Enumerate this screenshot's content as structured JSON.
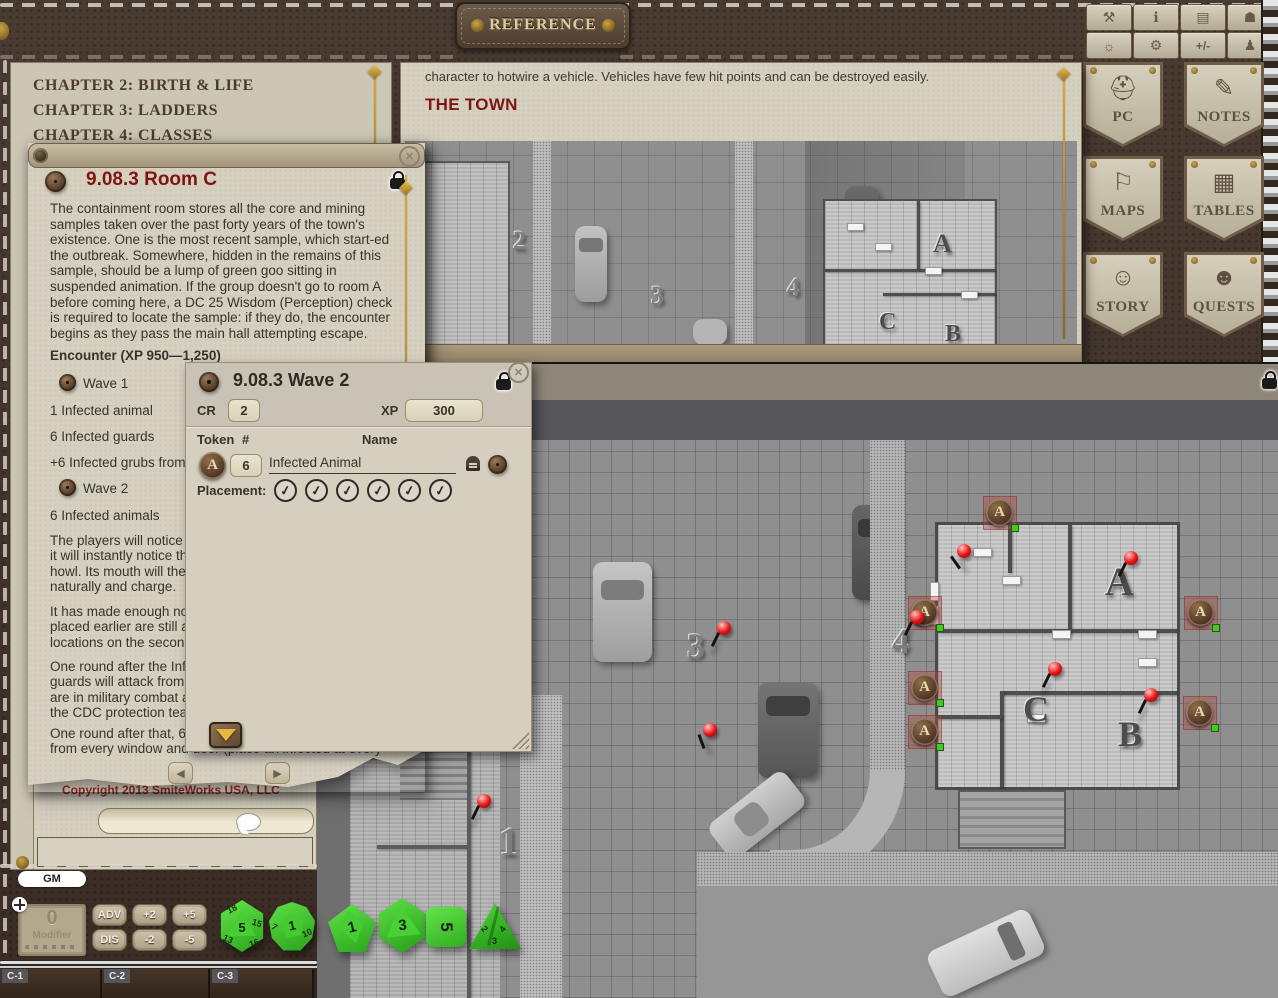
{
  "app": {
    "title_plaque": "REFERENCE",
    "close_glyph": "✕",
    "check_glyph": "✓",
    "left_arrow": "◀",
    "right_arrow": "▶"
  },
  "toolbar": {
    "icons": [
      {
        "name": "tools",
        "glyph": "⚒"
      },
      {
        "name": "party-info",
        "glyph": "ℹ"
      },
      {
        "name": "library",
        "glyph": "▤"
      },
      {
        "name": "dice-pouch",
        "glyph": "☗"
      },
      {
        "name": "day-night",
        "glyph": "☼"
      },
      {
        "name": "options",
        "glyph": "⚙"
      },
      {
        "name": "modifiers",
        "glyph": "+/-"
      },
      {
        "name": "character",
        "glyph": "♟"
      }
    ]
  },
  "sidebar": {
    "buttons": [
      {
        "label": "PC",
        "icon": "⛑"
      },
      {
        "label": "NOTES",
        "icon": "✎"
      },
      {
        "label": "MAPS",
        "icon": "⚐"
      },
      {
        "label": "TABLES",
        "icon": "▦"
      },
      {
        "label": "STORY",
        "icon": "☺"
      },
      {
        "label": "QUESTS",
        "icon": "☻"
      }
    ]
  },
  "chapters": {
    "items": [
      "CHAPTER 2: BIRTH & LIFE",
      "CHAPTER 3: LADDERS",
      "CHAPTER 4: CLASSES"
    ]
  },
  "story_window": {
    "intro": "character to hotwire a vehicle. Vehicles have few hit points and can be destroyed easily.",
    "heading": "THE TOWN",
    "labels": {
      "n2": "2",
      "n3": "3",
      "n4": "4",
      "a": "A",
      "b": "B",
      "c": "C"
    }
  },
  "room_window": {
    "title": "9.08.3 Room C",
    "p1": "The containment room stores all the core and mining samples taken over the past forty years of the town's existence. One is the most recent sample, which start-ed the outbreak. Somewhere, hidden in the remains of this sample, should be a lump of green goo sitting in suspended animation. If the group doesn't go to room A before coming here, a DC 25 Wisdom (Perception) check is required to locate the sample: if they do, the encounter begins as they pass the main hall attempting escape.",
    "encounter_heading": "Encounter (XP 950—1,250)",
    "wave1_label": "Wave 1",
    "wave1_items": [
      "1 Infected animal",
      "6 Infected guards",
      "+6 Infected grubs from o"
    ],
    "wave2_label": "Wave 2",
    "wave2_item": "6 Infected animals",
    "p2_lines": [
      "The players will notice ar",
      "it will instantly notice the",
      "howl. Its mouth will then",
      "naturally and charge."
    ],
    "p3_lines": [
      "It has made enough noise",
      "placed earlier are still aliv",
      "locations on the second r"
    ],
    "p4_lines": [
      "One round after the Infe",
      "guards will attack from th",
      "are in military combat ar",
      "the CDC protection team"
    ],
    "p5_lines": [
      "One round after that, 6 r",
      "from every window and door (place an infected at every"
    ]
  },
  "wave_window": {
    "title": "9.08.3 Wave 2",
    "cr_label": "CR",
    "cr_value": "2",
    "xp_label": "XP",
    "xp_value": "300",
    "col_token": "Token",
    "col_count": "#",
    "col_name": "Name",
    "token_letter": "A",
    "count_value": "6",
    "name_value": "Infected Animal",
    "placement_label": "Placement:"
  },
  "chat": {
    "copyright": "Copyright 2013 SmiteWorks USA, LLC"
  },
  "controls": {
    "gm": "GM",
    "modifier_value": "0",
    "modifier_label": "Modifier",
    "adv": "ADV",
    "dis": "DIS",
    "p2": "+2",
    "p5": "+5",
    "m2": "-2",
    "m5": "-5"
  },
  "dice": {
    "d20": "5",
    "d20_faces": [
      "18",
      "13",
      "15",
      "16"
    ],
    "d12": "1",
    "d12_faces": [
      "7",
      "10"
    ],
    "d10": "1",
    "d8": "3",
    "d6": "5",
    "d4_faces": [
      "2",
      "4",
      "3"
    ]
  },
  "tabs": {
    "items": [
      "C-1",
      "C-2",
      "C-3"
    ]
  },
  "map": {
    "labels": {
      "n1": "1",
      "n3": "3",
      "n4": "4",
      "a": "A",
      "b": "B",
      "c": "C"
    },
    "token_letter": "A"
  }
}
